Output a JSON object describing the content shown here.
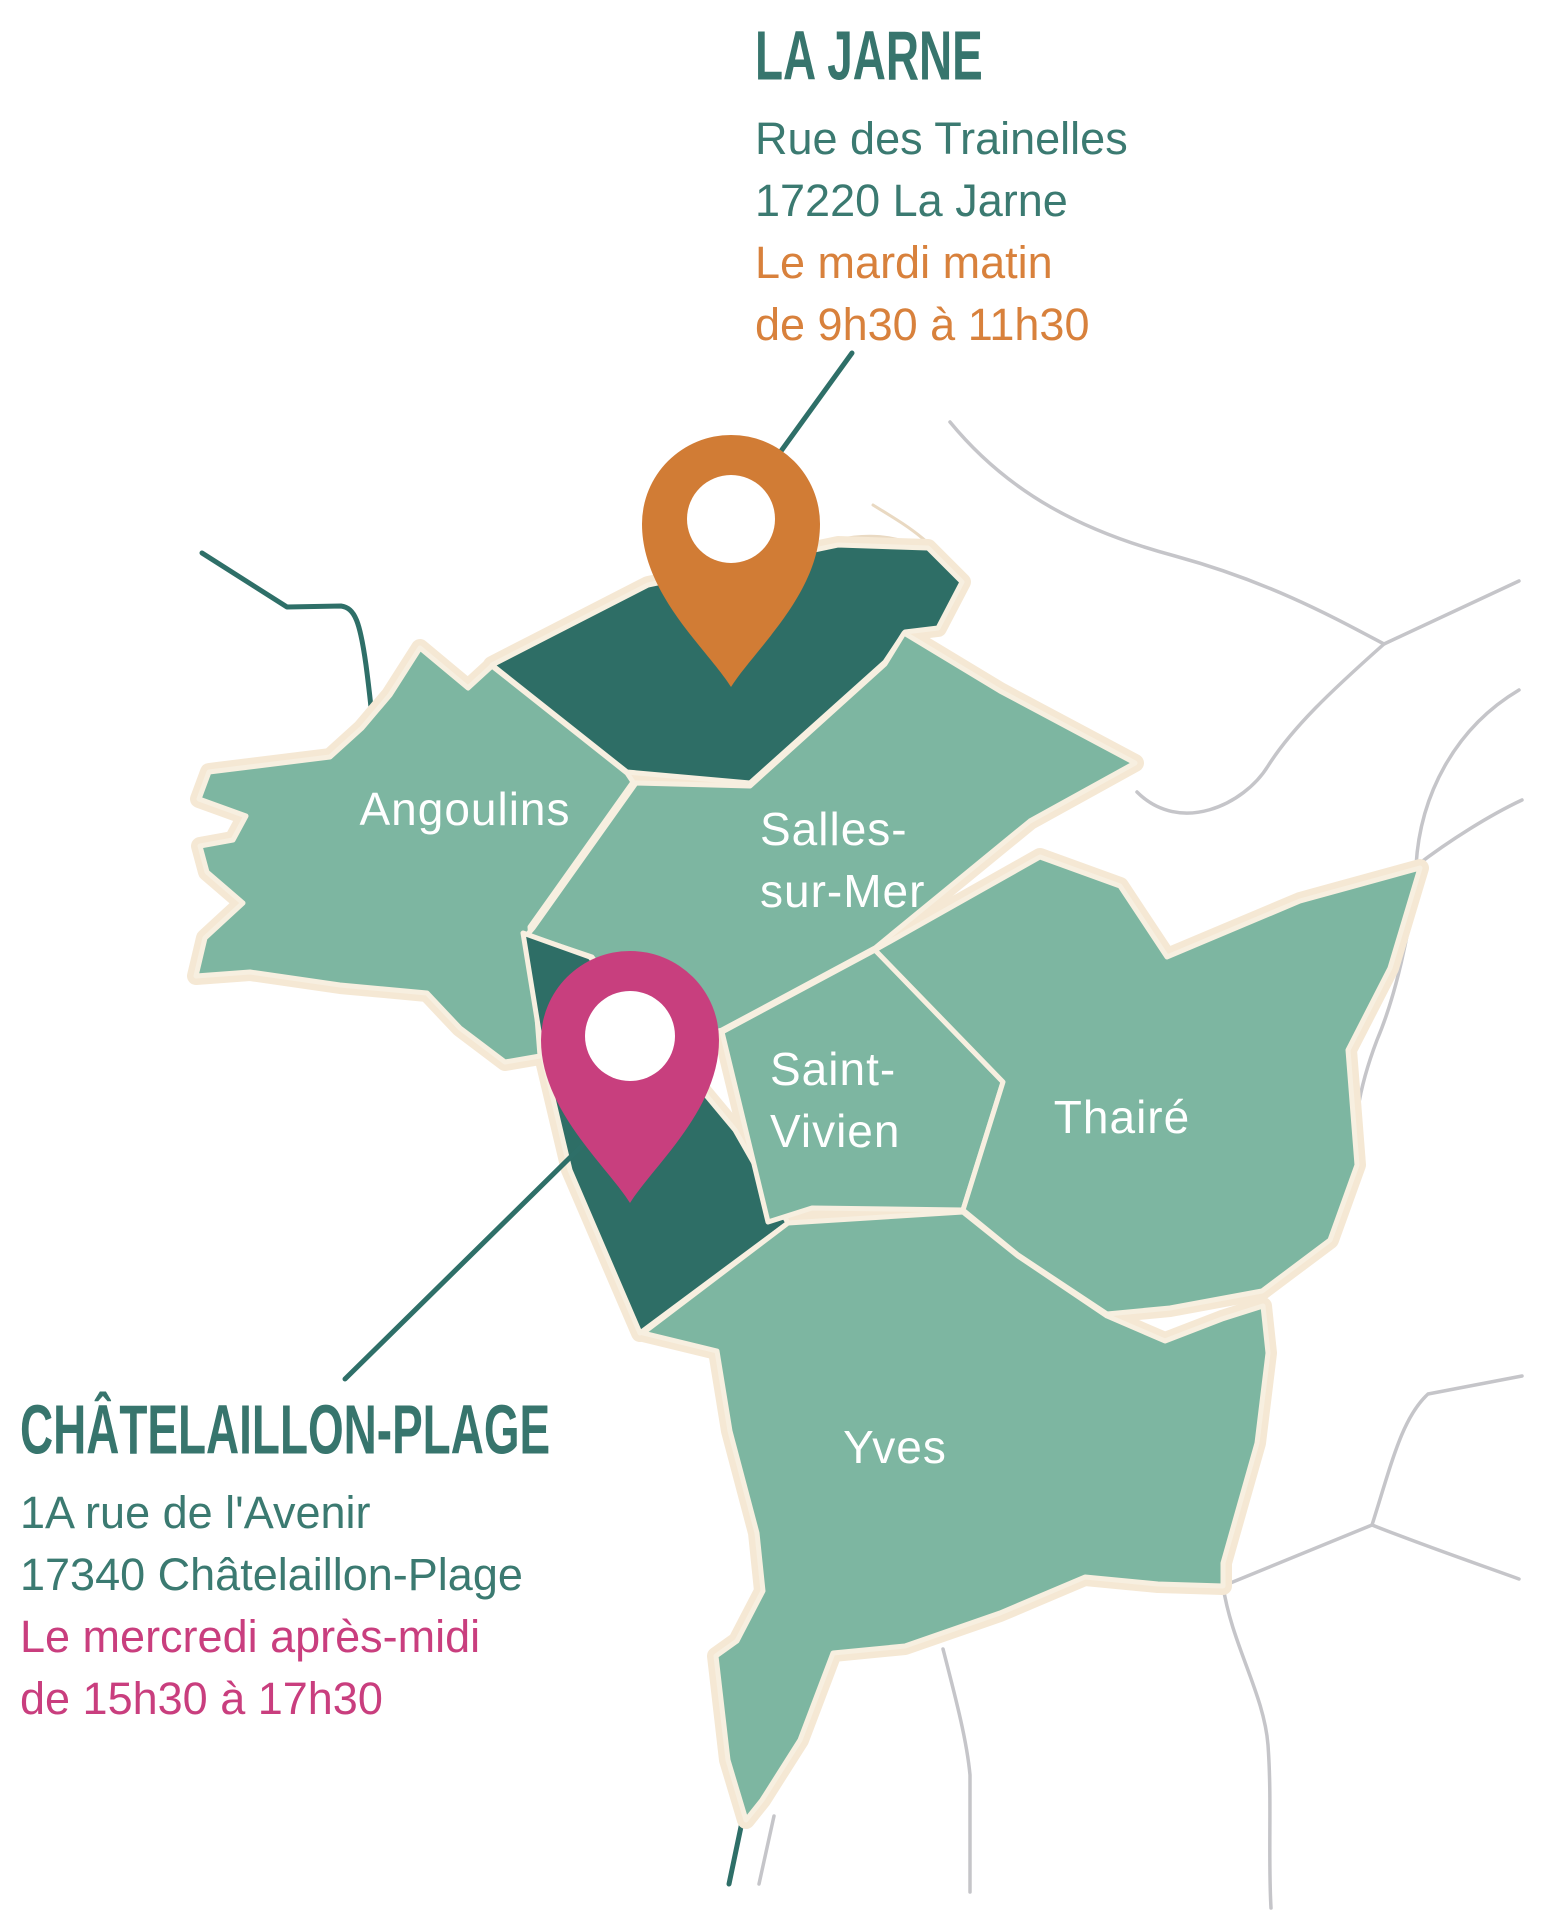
{
  "colors": {
    "commune_light": "#7db6a1",
    "commune_dark": "#2e6e66",
    "border_cream": "#f7efe0",
    "halo_cream": "#f5e8d4",
    "road_gray": "#c5c5c9",
    "road_beige": "#e9d9c2",
    "road_teal": "#2e6f68",
    "pin_orange": "#d17c35",
    "pin_pink": "#c83f7e",
    "text_teal": "#37756d",
    "text_orange": "#d8813c",
    "text_pink": "#c93e7e",
    "pin_hole_white": "#ffffff"
  },
  "la_jarne_block": {
    "title": "LA JARNE",
    "address_line1": "Rue des Trainelles",
    "address_line2": "17220 La Jarne",
    "schedule_line1": "Le mardi matin",
    "schedule_line2": "de 9h30 à 11h30"
  },
  "chatelaillon_block": {
    "title": "CHÂTELAILLON-PLAGE",
    "address_line1": "1A rue de l'Avenir",
    "address_line2": "17340 Châtelaillon-Plage",
    "schedule_line1": "Le mercredi après-midi",
    "schedule_line2": "de 15h30 à 17h30"
  },
  "map_labels": {
    "angoulins": "Angoulins",
    "salles_line1": "Salles-",
    "salles_line2": "sur-Mer",
    "saint_vivien_line1": "Saint-",
    "saint_vivien_line2": "Vivien",
    "thaire": "Thairé",
    "yves": "Yves"
  }
}
